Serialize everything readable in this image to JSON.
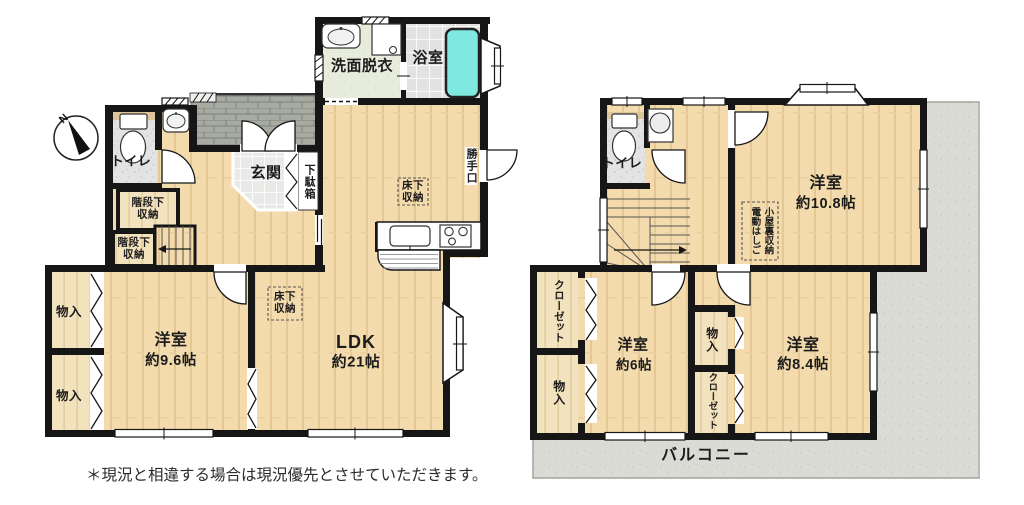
{
  "compass": {
    "north": "N"
  },
  "note": "＊現況と相違する場合は現況優先とさせていただきます。",
  "colors": {
    "wall": "#161616",
    "wood_floor": "#f3dbad",
    "closet_wood": "#f2e1bd",
    "bath_tub": "#7fe8e1",
    "balcony": "#dadbd4",
    "washroom_floor": "#e7ecdc",
    "porch_tile": "#a7aba1",
    "entrance_tile": "#e9e9e7"
  },
  "floor1": {
    "washroom": "洗面脱衣",
    "bathroom": "浴室",
    "toilet": "トイレ",
    "entrance": "玄関",
    "shoe_cabinet": "下駄箱",
    "back_door": "勝手口",
    "under_stairs_storage_1": [
      "階段下",
      "収納"
    ],
    "under_stairs_storage_2": [
      "階段下",
      "収納"
    ],
    "underfloor_storage_kitchen": [
      "床下",
      "収納"
    ],
    "underfloor_storage_ldk": [
      "床下",
      "収納"
    ],
    "storage_1": "物入",
    "storage_2": "物入",
    "western_room": {
      "name": "洋室",
      "size": "約9.6帖"
    },
    "ldk": {
      "name": "LDK",
      "size": "約21帖"
    }
  },
  "floor2": {
    "toilet": "トイレ",
    "western_room_large": {
      "name": "洋室",
      "size": "約10.8帖"
    },
    "attic_storage": {
      "line1": "小屋裏収納",
      "line2": "電動はしご"
    },
    "closet_1": "クローゼット",
    "storage_1": "物入",
    "western_room_6": {
      "name": "洋室",
      "size": "約6帖"
    },
    "storage_2": "物入",
    "closet_2": "クローゼット",
    "western_room_84": {
      "name": "洋室",
      "size": "約8.4帖"
    },
    "balcony": "バルコニー"
  }
}
